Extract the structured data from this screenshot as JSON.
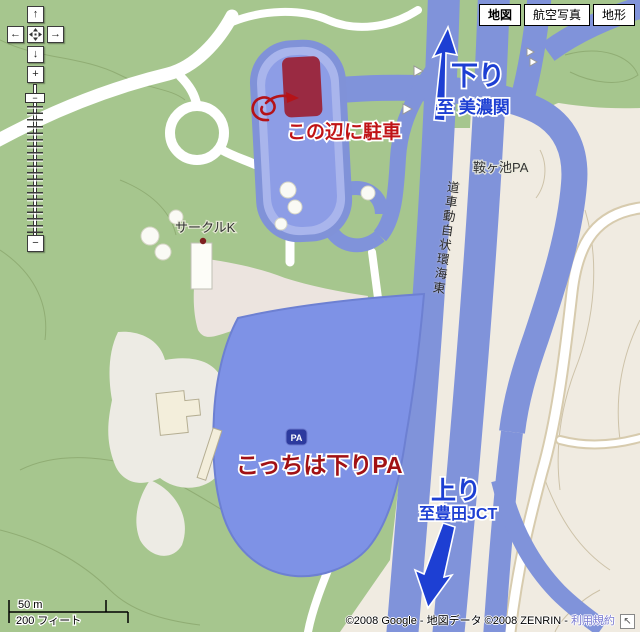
{
  "map_controls": {
    "pan_up_icon": "↑",
    "pan_down_icon": "↓",
    "pan_left_icon": "←",
    "pan_right_icon": "→",
    "center_icon": "pan-center-icon",
    "zoom_in_label": "+",
    "zoom_out_label": "−",
    "handle_label": "−"
  },
  "map_type_bar": {
    "buttons": [
      {
        "label": "地図",
        "selected": true
      },
      {
        "label": "航空写真",
        "selected": false
      },
      {
        "label": "地形",
        "selected": false
      }
    ]
  },
  "labels": {
    "pa_name": "鞍ヶ池PA",
    "store": "サークルK",
    "expressway": "東海環状自動車道",
    "pa_badge": "PA"
  },
  "annotations": {
    "park_here": "この辺に駐車",
    "this_is_down_pa": "こっちは下りPA",
    "down_direction": "下り",
    "down_destination": "至 美濃関",
    "up_direction": "上り",
    "up_destination": "至豊田JCT"
  },
  "scale_bar": {
    "metric": "50 m",
    "imperial": "200 フィート"
  },
  "attribution": {
    "text": "©2008 Google - 地図データ ©2008 ZENRIN - ",
    "link": "利用規約",
    "corner_icon": "↖"
  },
  "colors": {
    "land_green": "#a6c68e",
    "land_beige": "#f0ebe1",
    "highway_blue": "#8093da",
    "pa_area_blue": "#7e92e6",
    "parking_dark_red": "#9a2a42",
    "annotation_red": "#b51318",
    "route_blue": "#1d3fd3",
    "link_blue": "#7a7ad0"
  }
}
